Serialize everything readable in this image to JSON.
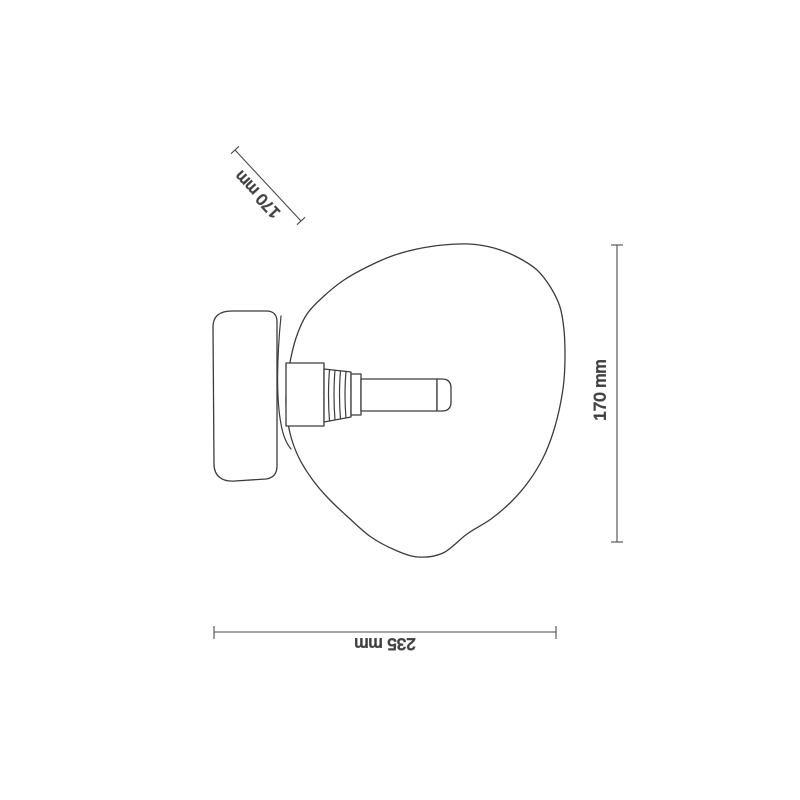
{
  "page": {
    "background": "#ffffff"
  },
  "palette": {
    "line": "#3c3c3b",
    "dimension_line": "#4b4b4b",
    "label_text": "#2e2e2e"
  },
  "diagram": {
    "subject": "wall lamp side-view line drawing",
    "dimensions": [
      {
        "id": "canopy-depth",
        "label": "170 mm",
        "orientation": "diagonal"
      },
      {
        "id": "overall-height",
        "label": "170 mm",
        "orientation": "vertical"
      },
      {
        "id": "overall-width",
        "label": "235 mm",
        "orientation": "horizontal"
      }
    ]
  }
}
